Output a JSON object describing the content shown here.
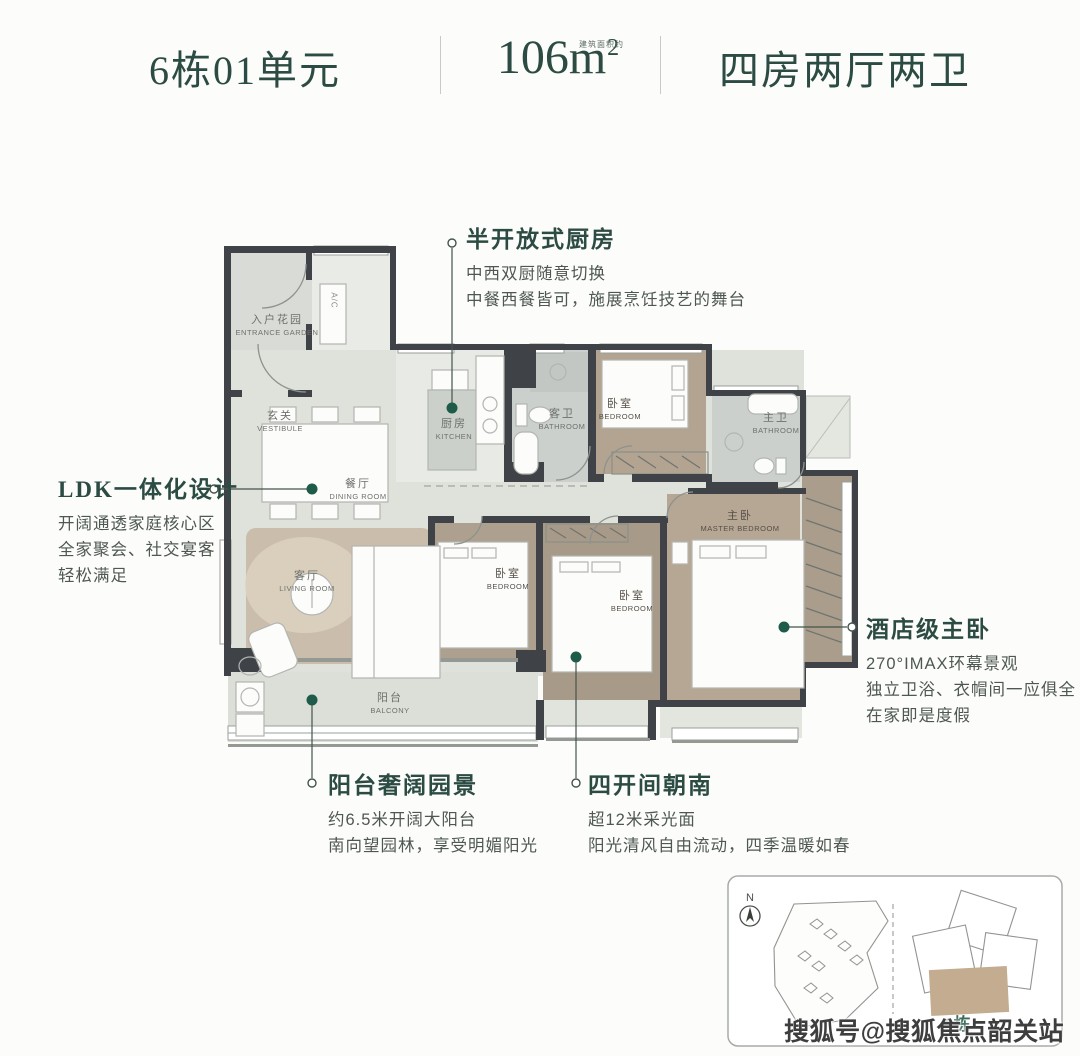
{
  "header": {
    "unit_label": "6栋01单元",
    "area": {
      "num": "106",
      "unit": "m",
      "sup": "2",
      "note": "建筑面积约"
    },
    "layout_label": "四房两厅两卫"
  },
  "callouts": {
    "kitchen": {
      "title": "半开放式厨房",
      "lines": [
        "中西双厨随意切换",
        "中餐西餐皆可，施展烹饪技艺的舞台"
      ]
    },
    "ldk": {
      "title": "LDK一体化设计",
      "lines": [
        "开阔通透家庭核心区",
        "全家聚会、社交宴客",
        "轻松满足"
      ]
    },
    "master": {
      "title": "酒店级主卧",
      "lines": [
        "270°IMAX环幕景观",
        "独立卫浴、衣帽间一应俱全",
        "在家即是度假"
      ]
    },
    "balcony": {
      "title": "阳台奢阔园景",
      "lines": [
        "约6.5米开阔大阳台",
        "南向望园林，享受明媚阳光"
      ]
    },
    "south": {
      "title": "四开间朝南",
      "lines": [
        "超12米采光面",
        "阳光清风自由流动，四季温暖如春"
      ]
    }
  },
  "rooms": {
    "entrance_garden": {
      "cn": "入户花园",
      "en": "ENTRANCE GARDEN"
    },
    "vestibule": {
      "cn": "玄关",
      "en": "VESTIBULE"
    },
    "ac": {
      "en": "A/C"
    },
    "kitchen": {
      "cn": "厨房",
      "en": "KITCHEN"
    },
    "guest_bath": {
      "cn": "客卫",
      "en": "BATHROOM"
    },
    "bedroom_top": {
      "cn": "卧室",
      "en": "BEDROOM"
    },
    "master_bath": {
      "cn": "主卫",
      "en": "BATHROOM"
    },
    "dining": {
      "cn": "餐厅",
      "en": "DINING ROOM"
    },
    "living": {
      "cn": "客厅",
      "en": "LIVING ROOM"
    },
    "bedroom_mid": {
      "cn": "卧室",
      "en": "BEDROOM"
    },
    "bedroom_south": {
      "cn": "卧室",
      "en": "BEDROOM"
    },
    "master_bedroom": {
      "cn": "主卧",
      "en": "MASTER BEDROOM"
    },
    "balcony": {
      "cn": "阳台",
      "en": "BALCONY"
    }
  },
  "sitemap": {
    "north_label": "N",
    "building_label": "6栋"
  },
  "watermark": "搜狐号@搜狐焦点韶关站",
  "colors": {
    "accent_green": "#2c4c43",
    "dot_green": "#1e5c49",
    "wall": "#3f4347",
    "wood": "#b3a492",
    "highlight_tan": "#c3ac90"
  }
}
